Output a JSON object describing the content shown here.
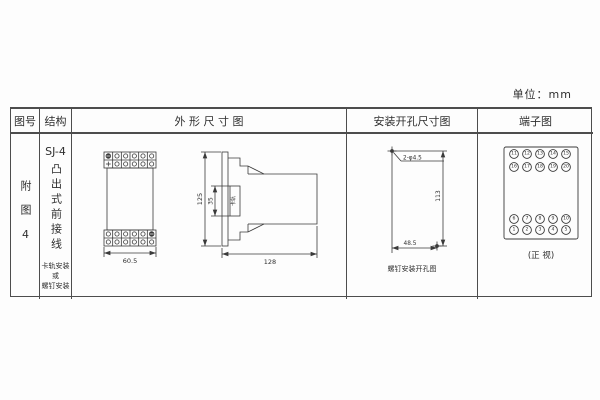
{
  "unit_label": "单位：mm",
  "table": {
    "headers": {
      "figure_no": "图号",
      "structure": "结构",
      "outline": "外 形 尺 寸 图",
      "install": "安装开孔尺寸图",
      "terminal": "端子图"
    }
  },
  "figure_cell": {
    "label": "附图4"
  },
  "structure_cell": {
    "model": "SJ-4",
    "type": "凸出式前接线",
    "note_lines": [
      "卡轨安装",
      "或",
      "螺钉安装"
    ]
  },
  "outline_drawing": {
    "front_width": "60.5",
    "height": "125",
    "rail_slot": "35",
    "rail_label": "卡轨",
    "depth": "128"
  },
  "install_drawing": {
    "holes": "2-φ4.5",
    "v_dist": "113",
    "h_dist": "48.5",
    "caption": "螺钉安装开孔图"
  },
  "terminal_diagram": {
    "groups": [
      {
        "rows": [
          [
            "11",
            "12",
            "13",
            "14",
            "15"
          ],
          [
            "16",
            "17",
            "18",
            "19",
            "20"
          ]
        ]
      },
      {
        "rows": [
          [
            "6",
            "7",
            "8",
            "9",
            "10"
          ],
          [
            "1",
            "2",
            "3",
            "4",
            "5"
          ]
        ]
      }
    ],
    "caption": "(正 视)"
  }
}
